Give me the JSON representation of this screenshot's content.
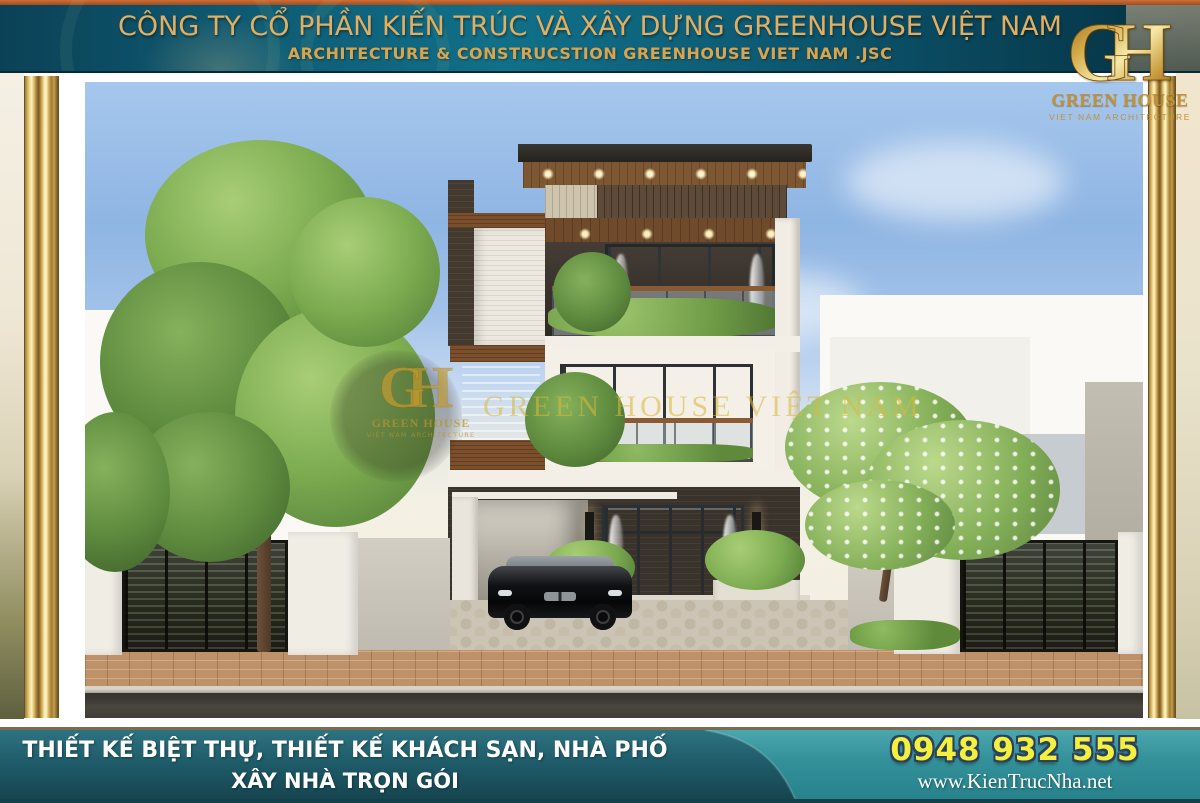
{
  "header": {
    "company_line1": "CÔNG TY CỔ PHẦN KIẾN TRÚC VÀ XÂY DỰNG GREENHOUSE VIỆT NAM",
    "company_line2": "ARCHITECTURE & CONSTRUCSTION GREENHOUSE VIET NAM .JSC"
  },
  "logo": {
    "monogram": "GH",
    "name": "GREEN HOUSE",
    "tagline": "VIET NAM ARCHITECTURE"
  },
  "watermark": {
    "monogram": "GH",
    "name": "GREEN HOUSE",
    "tagline": "VIỆT NAM ARCHITECTURE",
    "text": "GREEN HOUSE VIỆT NAM"
  },
  "footer": {
    "services_line1": "THIẾT KẾ BIỆT THỰ, THIẾT KẾ KHÁCH SẠN, NHÀ PHỐ",
    "services_line2": "XÂY NHÀ TRỌN GÓI",
    "phone": "0948 932 555",
    "website": "www.KienTrucNha.net"
  },
  "colors": {
    "gold_text": "#E2AE62",
    "gold_text2": "#D9A44E",
    "logo_gold": "#BE923B",
    "banner_teal": "#0E5A73",
    "banner_strip_orange": "#B85E2B",
    "footer_dark_teal": "#1D5664",
    "footer_light_teal": "#35969F",
    "phone_yellow": "#F4F13C",
    "phone_outline": "#2B415E",
    "watermark_gold": "rgba(215,185,60,0.58)"
  }
}
